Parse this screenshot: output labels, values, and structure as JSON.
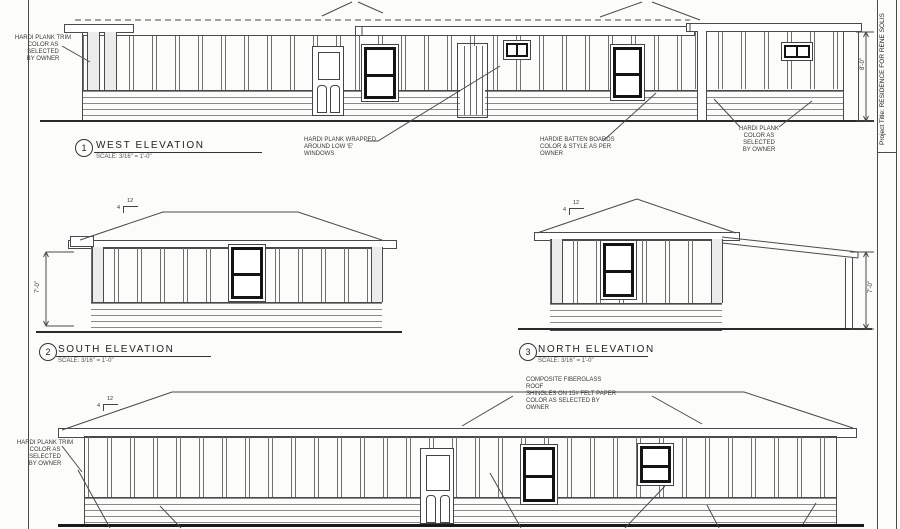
{
  "sheet": {
    "project_title": "Project Title: RESIDENCE FOR  RENE SOLIS"
  },
  "titles": {
    "west": {
      "num": "1",
      "label": "WEST  ELEVATION",
      "scale": "SCALE: 3/16\" = 1'-0\""
    },
    "south": {
      "num": "2",
      "label": "SOUTH ELEVATION",
      "scale": "SCALE: 3/16\" = 1'-0\""
    },
    "north": {
      "num": "3",
      "label": "NORTH ELEVATION",
      "scale": "SCALE: 3/16\" = 1'-0\""
    }
  },
  "annotations": {
    "hardi_trim": "HARDI PLANK TRIM\nCOLOR AS SELECTED\nBY OWNER",
    "hardi_wrapped": "HARDI PLANK WRAPPED\nAROUND LOW 'E' WINDOWS",
    "hardie_batten": "HARDIE BATTEN BOARDS\nCOLOR & STYLE AS PER OWNER",
    "hardi_plank": "HARDI PLANK\nCOLOR AS SELECTED\nBY OWNER",
    "roof_shingles": "COMPOSITE FIBERGLASS ROOF\nSHINGLES ON 15# FELT PAPER\nCOLOR AS SELECTED BY OWNER"
  },
  "dimensions": {
    "south_height": "7'-0\"",
    "north_height": "7'-0\"",
    "west_height": "8'-0\"",
    "pitch_run": "12",
    "pitch_rise": "4"
  }
}
